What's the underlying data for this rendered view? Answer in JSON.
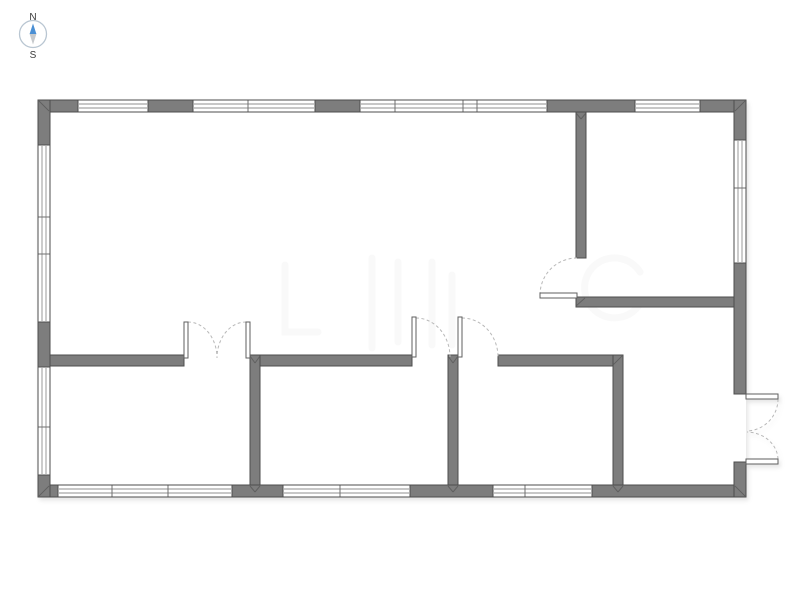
{
  "compass": {
    "north_label": "N",
    "south_label": "S"
  },
  "colors": {
    "floor": "#ffffff",
    "wall_fill": "#7d7d7d",
    "wall_edge": "#4d4d4d",
    "window_fill": "#ffffff",
    "window_line": "#8f8f8f",
    "window_divider": "#6f6f6f",
    "door_fill": "#ffffff",
    "door_edge": "#5f5f5f",
    "door_arc": "#b8b8b8",
    "miter": "#5a5a5a",
    "watermark": "#888888",
    "compass_ring": "#b9c6d2",
    "compass_north": "#4a8fd4",
    "compass_south": "#c6c9cc",
    "compass_text": "#3a3a3a"
  },
  "floorplan": {
    "outline": {
      "x": 38,
      "y": 100,
      "w": 708,
      "h": 397
    },
    "exterior_walls": [
      {
        "name": "wall-exterior-top",
        "x": 38,
        "y": 100,
        "w": 708,
        "h": 12
      },
      {
        "name": "wall-exterior-bottom",
        "x": 38,
        "y": 485,
        "w": 708,
        "h": 12
      },
      {
        "name": "wall-exterior-left",
        "x": 38,
        "y": 100,
        "w": 12,
        "h": 397
      },
      {
        "name": "wall-exterior-right-upper",
        "x": 734,
        "y": 100,
        "w": 12,
        "h": 294
      },
      {
        "name": "wall-exterior-right-lower",
        "x": 734,
        "y": 462,
        "w": 12,
        "h": 35
      }
    ],
    "interior_walls": [
      {
        "name": "wall-topright-room-left",
        "x": 576,
        "y": 112,
        "w": 10,
        "h": 146
      },
      {
        "name": "wall-topright-room-bottom",
        "x": 576,
        "y": 297,
        "w": 158,
        "h": 10
      },
      {
        "name": "wall-middle-left",
        "x": 50,
        "y": 355,
        "w": 134,
        "h": 11
      },
      {
        "name": "wall-middle-center",
        "x": 250,
        "y": 355,
        "w": 162,
        "h": 11
      },
      {
        "name": "wall-middle-right",
        "x": 498,
        "y": 355,
        "w": 125,
        "h": 11
      },
      {
        "name": "wall-vertical-left",
        "x": 250,
        "y": 355,
        "w": 10,
        "h": 130
      },
      {
        "name": "wall-vertical-mid",
        "x": 448,
        "y": 355,
        "w": 10,
        "h": 130
      },
      {
        "name": "wall-vertical-right",
        "x": 613,
        "y": 355,
        "w": 10,
        "h": 130
      }
    ],
    "windows": [
      {
        "name": "window-top-1",
        "orient": "h",
        "x": 78,
        "y": 100,
        "len": 70,
        "dividers": []
      },
      {
        "name": "window-top-2",
        "orient": "h",
        "x": 193,
        "y": 100,
        "len": 122,
        "dividers": [
          248
        ]
      },
      {
        "name": "window-top-3",
        "orient": "h",
        "x": 360,
        "y": 100,
        "len": 187,
        "dividers": [
          395,
          463,
          477
        ]
      },
      {
        "name": "window-top-4",
        "orient": "h",
        "x": 635,
        "y": 100,
        "len": 65,
        "dividers": []
      },
      {
        "name": "window-bottom-1",
        "orient": "h",
        "x": 58,
        "y": 485,
        "len": 174,
        "dividers": [
          112,
          168
        ]
      },
      {
        "name": "window-bottom-2",
        "orient": "h",
        "x": 283,
        "y": 485,
        "len": 127,
        "dividers": [
          340
        ]
      },
      {
        "name": "window-bottom-3",
        "orient": "h",
        "x": 493,
        "y": 485,
        "len": 99,
        "dividers": [
          525
        ]
      },
      {
        "name": "window-left-1",
        "orient": "v",
        "x": 38,
        "y": 145,
        "len": 177,
        "dividers": [
          217,
          254
        ]
      },
      {
        "name": "window-left-2",
        "orient": "v",
        "x": 38,
        "y": 367,
        "len": 108,
        "dividers": [
          427
        ]
      },
      {
        "name": "window-right-1",
        "orient": "v",
        "x": 734,
        "y": 140,
        "len": 123,
        "dividers": [
          188
        ]
      }
    ],
    "doors": [
      {
        "name": "door-interior-double",
        "leaves": [
          {
            "x": 184,
            "y": 322,
            "w": 4,
            "h": 36
          },
          {
            "x": 246,
            "y": 322,
            "w": 4,
            "h": 36
          }
        ],
        "arcs": [
          "M188,322 A29,36 0 0 1 217,358",
          "M246,322 A29,36 0 0 0 217,358"
        ]
      },
      {
        "name": "door-room-mid-1",
        "leaves": [
          {
            "x": 412,
            "y": 317,
            "w": 4,
            "h": 40
          }
        ],
        "arcs": [
          "M416,318 A34,39 0 0 1 450,357"
        ]
      },
      {
        "name": "door-room-mid-2",
        "leaves": [
          {
            "x": 458,
            "y": 317,
            "w": 4,
            "h": 40
          }
        ],
        "arcs": [
          "M462,318 A36,39 0 0 1 498,357"
        ]
      },
      {
        "name": "door-topright-room",
        "leaves": [
          {
            "x": 540,
            "y": 293,
            "w": 37,
            "h": 5
          }
        ],
        "arcs": [
          "M540,295 A37,37 0 0 1 577,258"
        ]
      },
      {
        "name": "door-exterior-double",
        "leaves": [
          {
            "x": 746,
            "y": 394,
            "w": 32,
            "h": 5
          },
          {
            "x": 746,
            "y": 459,
            "w": 32,
            "h": 5
          }
        ],
        "arcs": [
          "M778,399 A32,32 0 0 1 747,431",
          "M778,459 A32,28 0 0 0 747,432"
        ]
      }
    ],
    "miters": [
      [
        39,
        101,
        49,
        111
      ],
      [
        745,
        101,
        735,
        111
      ],
      [
        39,
        496,
        49,
        486
      ],
      [
        745,
        496,
        735,
        486
      ],
      [
        576,
        306,
        585,
        298
      ],
      [
        613,
        365,
        622,
        356
      ],
      [
        250,
        356,
        255,
        363
      ],
      [
        260,
        356,
        255,
        363
      ],
      [
        448,
        356,
        453,
        363
      ],
      [
        458,
        356,
        453,
        363
      ],
      [
        576,
        113,
        581,
        119
      ],
      [
        586,
        113,
        581,
        119
      ],
      [
        250,
        486,
        255,
        492
      ],
      [
        260,
        486,
        255,
        492
      ],
      [
        448,
        486,
        453,
        492
      ],
      [
        458,
        486,
        453,
        492
      ],
      [
        613,
        486,
        618,
        492
      ],
      [
        623,
        486,
        618,
        492
      ]
    ]
  },
  "watermark": {
    "opacity": 0.05,
    "shapes": [
      "M285,265 L285,332 L318,332",
      "M372,258 L372,348",
      "M398,262 L398,342",
      "M432,262 L432,345",
      "M452,275 L452,345",
      "M640,272 A30,30 0 1 0 642,300"
    ]
  }
}
